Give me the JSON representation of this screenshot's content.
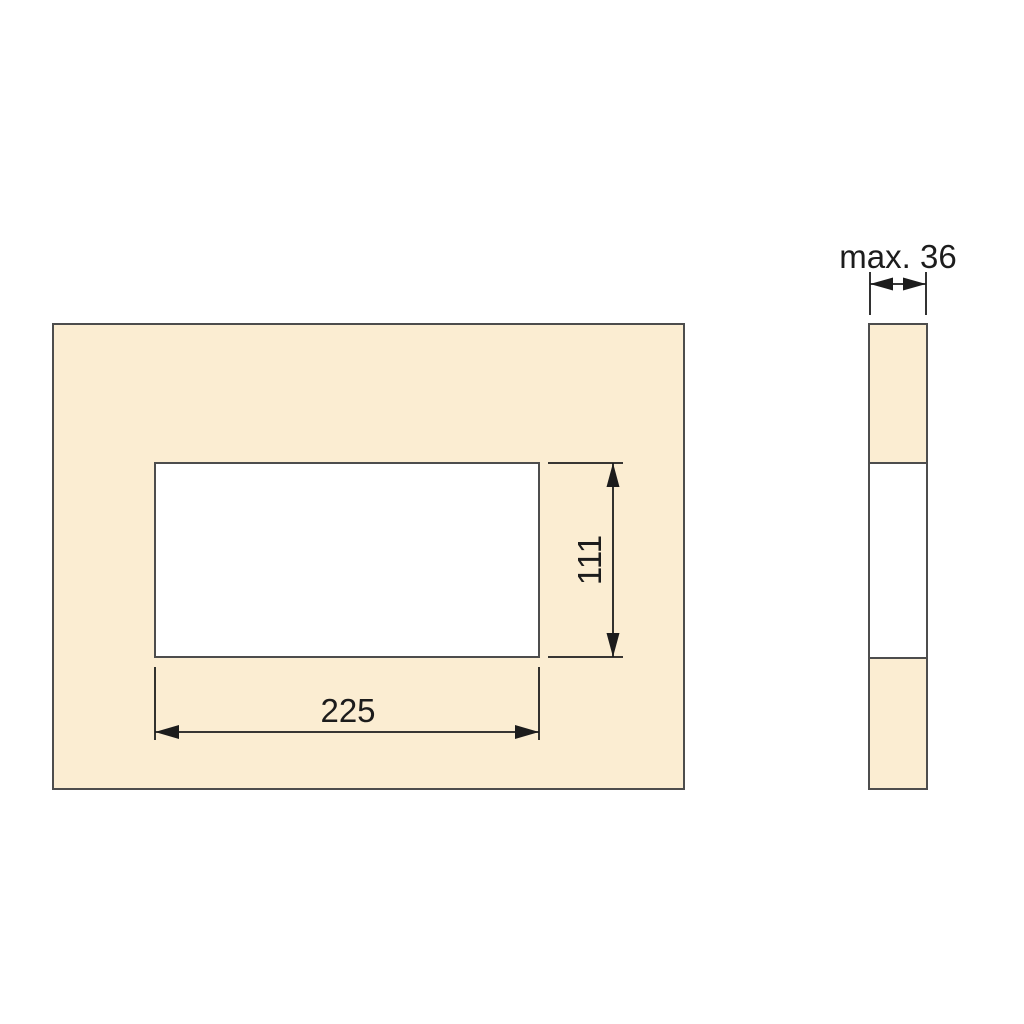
{
  "drawing": {
    "front_view": {
      "width_label": "225",
      "height_label": "111"
    },
    "side_view": {
      "thickness_label": "max. 36"
    }
  },
  "colors": {
    "panel_fill": "#FBEDD2",
    "cutout_fill": "#FFFFFF",
    "panel_stroke": "#4D4D4D",
    "dimension_color": "#1C1C1C",
    "background": "#FFFFFF"
  }
}
